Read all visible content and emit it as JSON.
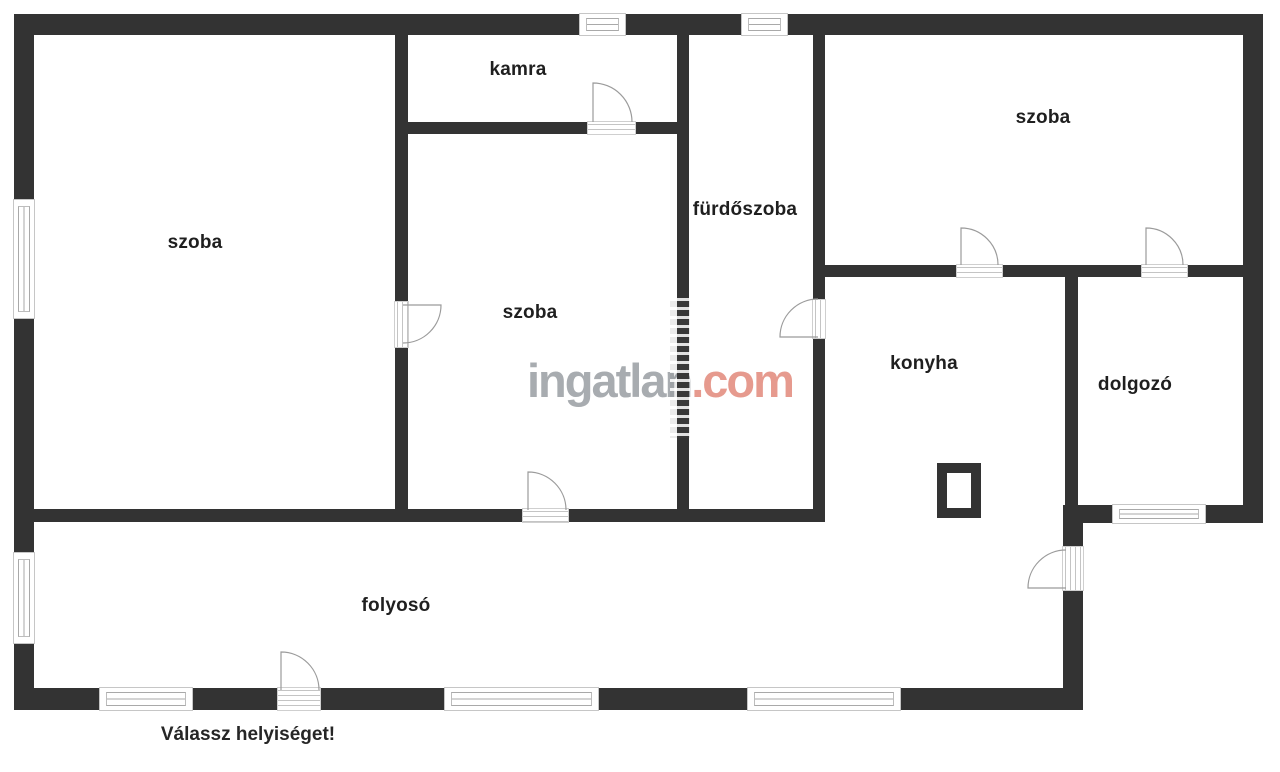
{
  "rooms": {
    "room_left": "szoba",
    "pantry": "kamra",
    "bathroom": "fürdőszoba",
    "room_middle": "szoba",
    "room_top_right": "szoba",
    "kitchen": "konyha",
    "study": "dolgozó",
    "hallway": "folyosó"
  },
  "watermark": {
    "brand": "ingatlan.com",
    "part_gray": "ingatlan",
    "part_accent": ".com"
  },
  "footer": {
    "prompt": "Válassz helyiséget!"
  },
  "colors": {
    "wall": "#333333",
    "label_text": "#1f1f1f",
    "watermark_gray": "#a8acb0",
    "watermark_accent": "#e69a8e",
    "symbol_line": "#9b9b9b"
  }
}
